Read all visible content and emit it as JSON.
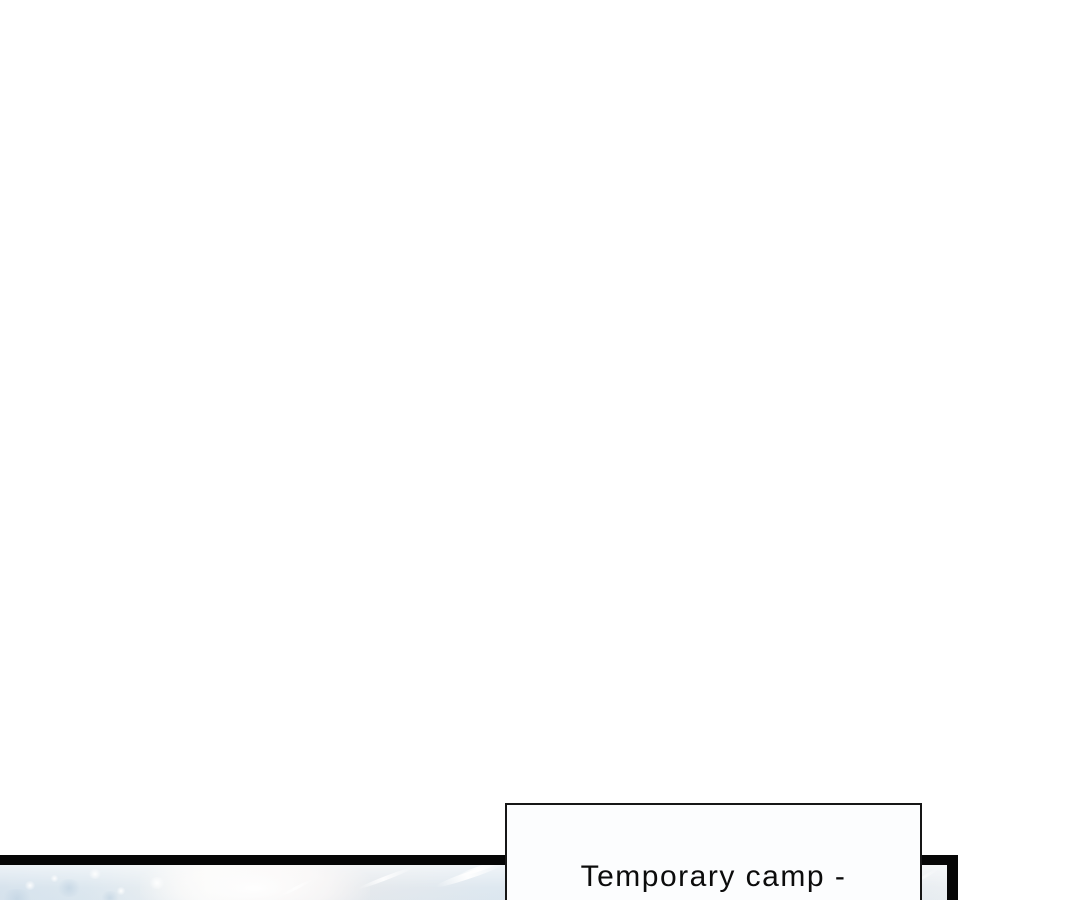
{
  "page": {
    "background_color": "#ffffff"
  },
  "comic": {
    "panel": {
      "border_color": "#060606",
      "artwork": "icy-blue-snowscape-with-wind-streaks",
      "artwork_colors": [
        "#d7e3ed",
        "#f4f6f5",
        "#ede9ea",
        "#d9e4ee",
        "#ebeff2"
      ]
    },
    "caption": {
      "text": "Temporary camp -",
      "background_color": "#fcfdfe",
      "border_color": "#161616",
      "text_color": "#0c0c0c"
    }
  }
}
